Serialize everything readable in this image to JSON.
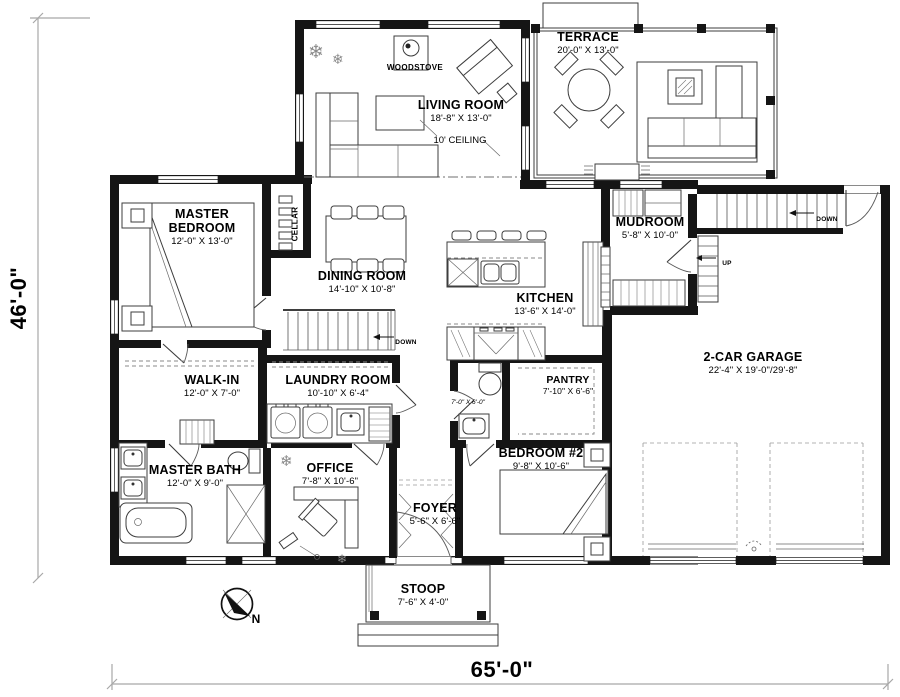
{
  "plan": {
    "overall_width": "65'-0\"",
    "overall_height": "46'-0\"",
    "north_label": "N"
  },
  "rooms": {
    "terrace": {
      "name": "TERRACE",
      "dims": "20'-0\" X 13'-0\""
    },
    "living_room": {
      "name": "LIVING ROOM",
      "dims": "18'-8\" X 13'-0\"",
      "ceiling_note": "10' CEILING"
    },
    "woodstove": {
      "name": "WOODSTOVE"
    },
    "master_bedroom": {
      "name": "MASTER BEDROOM",
      "dims": "12'-0\" X 13'-0\""
    },
    "cellar": {
      "name": "CELLAR"
    },
    "dining_room": {
      "name": "DINING ROOM",
      "dims": "14'-10\" X 10'-8\""
    },
    "kitchen": {
      "name": "KITCHEN",
      "dims": "13'-6\" X 14'-0\""
    },
    "mudroom": {
      "name": "MUDROOM",
      "dims": "5'-8\" X 10'-0\""
    },
    "garage": {
      "name": "2-CAR GARAGE",
      "dims": "22'-4\" X 19'-0\"/29'-8\""
    },
    "walk_in": {
      "name": "WALK-IN",
      "dims": "12'-0\" X 7'-0\""
    },
    "laundry_room": {
      "name": "LAUNDRY ROOM",
      "dims": "10'-10\" X 6'-4\""
    },
    "pantry": {
      "name": "PANTRY",
      "dims": "7'-10\" X 6'-6\""
    },
    "powder_room": {
      "dims": "7'-0\" X 6'-0\""
    },
    "master_bath": {
      "name": "MASTER BATH",
      "dims": "12'-0\" X 9'-0\""
    },
    "office": {
      "name": "OFFICE",
      "dims": "7'-8\" X 10'-6\""
    },
    "bedroom_2": {
      "name": "BEDROOM #2",
      "dims": "9'-8\" X 10'-6\""
    },
    "foyer": {
      "name": "FOYER",
      "dims": "5'-6\" X 6'-6\""
    },
    "stoop": {
      "name": "STOOP",
      "dims": "7'-6\" X 4'-0\""
    }
  },
  "annotations": {
    "down": "DOWN",
    "up": "UP"
  },
  "glyphs": {
    "plant": "❄"
  }
}
